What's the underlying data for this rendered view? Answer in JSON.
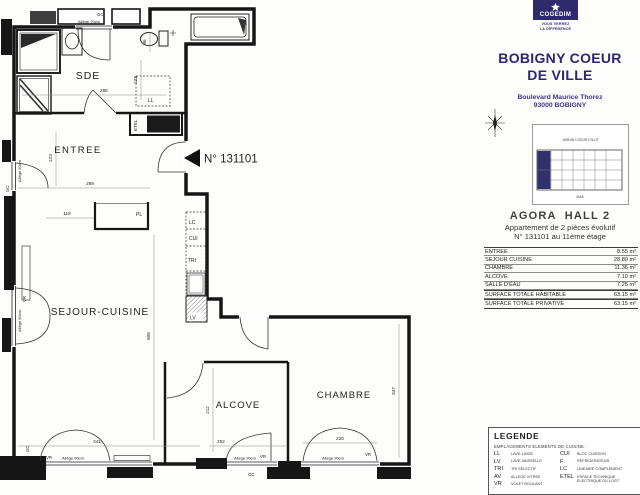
{
  "branding": {
    "logo_text": "COGEDIM",
    "tagline_line1": "VOUS VERREZ",
    "tagline_line2": "LA DIFFÉRENCE",
    "title_line1": "BOBIGNY COEUR",
    "title_line2": "DE VILLE",
    "address_line1": "Boulevard Maurice Thorez",
    "address_line2": "93000 BOBIGNY",
    "navy": "#2e2a6b"
  },
  "key_plan": {
    "top_label": "JARDIN COEUR D'ILOT",
    "bottom_label": "MAIL"
  },
  "listing": {
    "hall": "AGORA  HALL 2",
    "type": "Appartement de 2 pièces évolutif",
    "unit": "N° 131101 au 11ème étage"
  },
  "areas": {
    "rows": [
      {
        "label": "ENTREE",
        "value": "8.55 m²"
      },
      {
        "label": "SEJOUR CUISINE",
        "value": "28.89 m²"
      },
      {
        "label": "CHAMBRE",
        "value": "11.36 m²"
      },
      {
        "label": "ALCOVE",
        "value": "7.10 m²"
      },
      {
        "label": "SALLE D'EAU",
        "value": "7.25 m²"
      },
      {
        "label": "SURFACE TOTALE HABITABLE",
        "value": "63.15 m²"
      },
      {
        "label": "SURFACE TOTALE PRIVATIVE",
        "value": "63.15 m²"
      }
    ]
  },
  "legend": {
    "title": "LEGENDE",
    "subtitle": "EMPLACEMENTS ELEMENTS DE CUISINE :",
    "col1": [
      {
        "abbr": "LL",
        "desc": "LAVE-LINGE"
      },
      {
        "abbr": "LV",
        "desc": "LAVE-VAISSELLE"
      },
      {
        "abbr": "TRI",
        "desc": "TRI SELECTIF"
      },
      {
        "abbr": "AV",
        "desc": "ALLEGE VITREE"
      },
      {
        "abbr": "VR",
        "desc": "VOLET ROULANT"
      }
    ],
    "col2": [
      {
        "abbr": "CUI",
        "desc": "BLOC CUISSON"
      },
      {
        "abbr": "F",
        "desc": "REFRIGERATEUR"
      },
      {
        "abbr": "LC",
        "desc": "LINEAIRE COMPLEMENT"
      },
      {
        "abbr": "ETEL",
        "desc": "ESPACE TECHNIQUE ELECTRIQUE DU LOGT"
      }
    ]
  },
  "plan": {
    "marker": "N° 131101",
    "rooms": {
      "sde": "SDE",
      "entree": "ENTREE",
      "sejour": "SEJOUR-CUISINE",
      "alcove": "ALCOVE",
      "chambre": "CHAMBRE"
    },
    "fix": {
      "ll": "LL",
      "lv": "LV",
      "tri": "TRI",
      "cui": "CUI",
      "lc": "LC",
      "pl": "PL",
      "etel": "ETEL"
    },
    "wall": {
      "gc": "GC",
      "vr": "VR"
    },
    "allege70": "Allège 70cm",
    "allege90": "Allège 90cm",
    "dims": {
      "d96": "96",
      "d123": "123",
      "d223": "223",
      "d286": "286",
      "d289": "289",
      "d118": "118",
      "d608": "608",
      "d341": "341",
      "d252": "252",
      "d212": "212",
      "d226": "226",
      "d347": "347"
    }
  }
}
